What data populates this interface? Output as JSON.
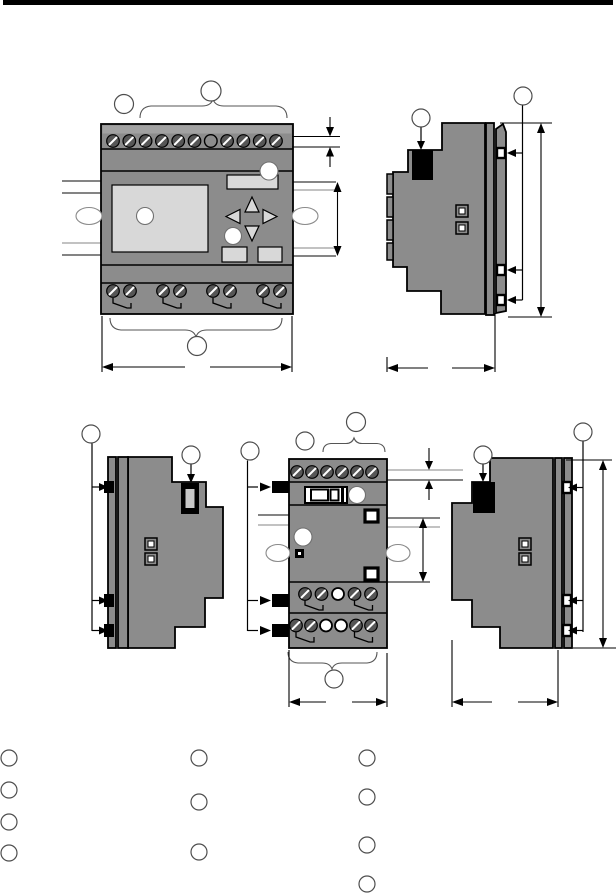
{
  "document": {
    "kind": "dimension-drawing-page",
    "top_rule_color": "#000000",
    "background": "#ffffff"
  },
  "colors": {
    "device_body": "#8c8c8c",
    "device_top_band": "#a2a2a2",
    "panel_light": "#d8d8d8",
    "screw_dark": "#565656",
    "outline": "#000000",
    "callout_stroke": "#4d4d4d",
    "shadow_line": "#c2c2c2"
  },
  "figures": {
    "base_front_view": {
      "callouts": [
        "",
        "",
        ""
      ]
    },
    "base_side_view": {
      "callouts": [
        "",
        ""
      ]
    },
    "expansion_left_side_view": {
      "callouts": [
        "",
        ""
      ]
    },
    "expansion_front_view": {
      "callouts": [
        "",
        "",
        "",
        ""
      ]
    },
    "expansion_right_side_view": {
      "callouts": [
        "",
        ""
      ]
    }
  },
  "legend": {
    "columns": [
      {
        "bullets": [
          "",
          "",
          "",
          ""
        ]
      },
      {
        "bullets": [
          "",
          "",
          ""
        ]
      },
      {
        "bullets": [
          "",
          "",
          "",
          ""
        ]
      }
    ]
  }
}
